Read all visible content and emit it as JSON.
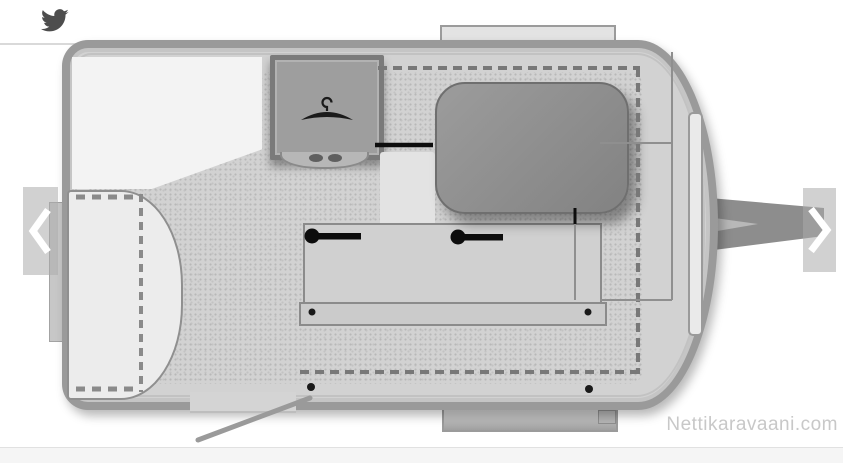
{
  "meta": {
    "watermark": "Nettikaravaani.com"
  },
  "share": {
    "icon": "twitter-bird",
    "icon_color": "#4d4d4d"
  },
  "carousel": {
    "prev_icon": "chevron-left",
    "next_icon": "chevron-right",
    "arrow_color": "#ffffff",
    "overlay_color": "rgba(172,172,172,0.55)"
  },
  "floorplan": {
    "type": "caravan-top-view-layout",
    "wardrobe_icon": "clothes-hanger",
    "components": [
      "front-bed",
      "wardrobe",
      "wardrobe-step",
      "dinette-table",
      "bench-seat",
      "side-unit",
      "entry-door",
      "drawbar-hitch",
      "roof-window",
      "rear-bumper",
      "front-window-strip",
      "folding-bed-outline"
    ],
    "colors": {
      "wall": "#9a9a9a",
      "floor": "#d2d2d2",
      "table": "#8d8d8d",
      "wardrobe": "#9e9e9e",
      "bed": "#f3f3f3",
      "marker_black": "#111111",
      "hitch": "#8d8d8d"
    }
  },
  "footer": {
    "strip_color": "#f5f5f5",
    "divider_color": "#e1e1e1"
  }
}
